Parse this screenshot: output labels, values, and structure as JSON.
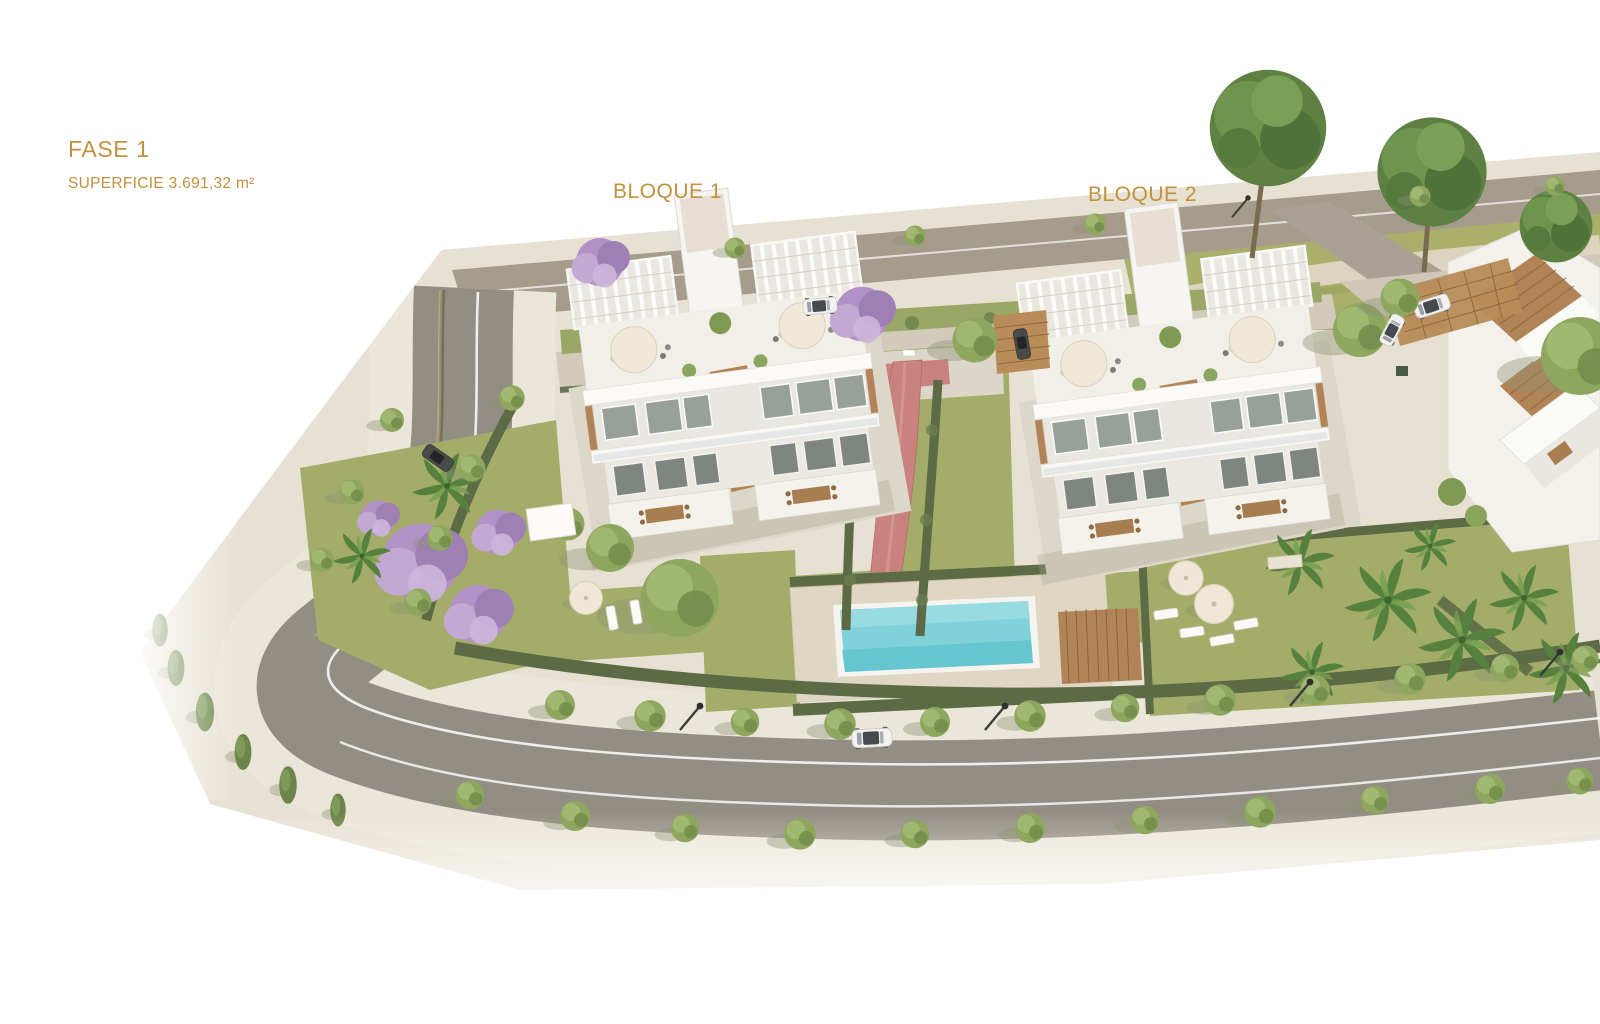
{
  "labels": {
    "phase_title": "FASE 1",
    "phase_area": "SUPERFICIE 3.691,32 m²",
    "block1": "BLOQUE 1",
    "block2": "BLOQUE 2"
  },
  "palette": {
    "label_text": "#c2913e",
    "terrain": "#e7e1d3",
    "road": "#938e83",
    "road_top": "#a59c8c",
    "sidewalk": "#ebe6da",
    "grass": "#a3ad69",
    "hedge": "#5c6b45",
    "water": "#7fd2da",
    "pool_deck": "#e0d6c4",
    "wood": "#b28356",
    "path_red": "#c9827e",
    "building": "#f4f2ed"
  },
  "scene": {
    "objects": [
      "bloque-1-building",
      "bloque-2-building",
      "neighboring-building",
      "communal-pool",
      "wood-sun-deck",
      "red-pedestrian-path",
      "perimeter-road",
      "street-trees",
      "white-car-on-road",
      "parked-cars",
      "garden-lawns",
      "jacaranda-trees",
      "palm-trees",
      "rooftop-pergolas",
      "sun-umbrellas",
      "street-lamps"
    ]
  }
}
